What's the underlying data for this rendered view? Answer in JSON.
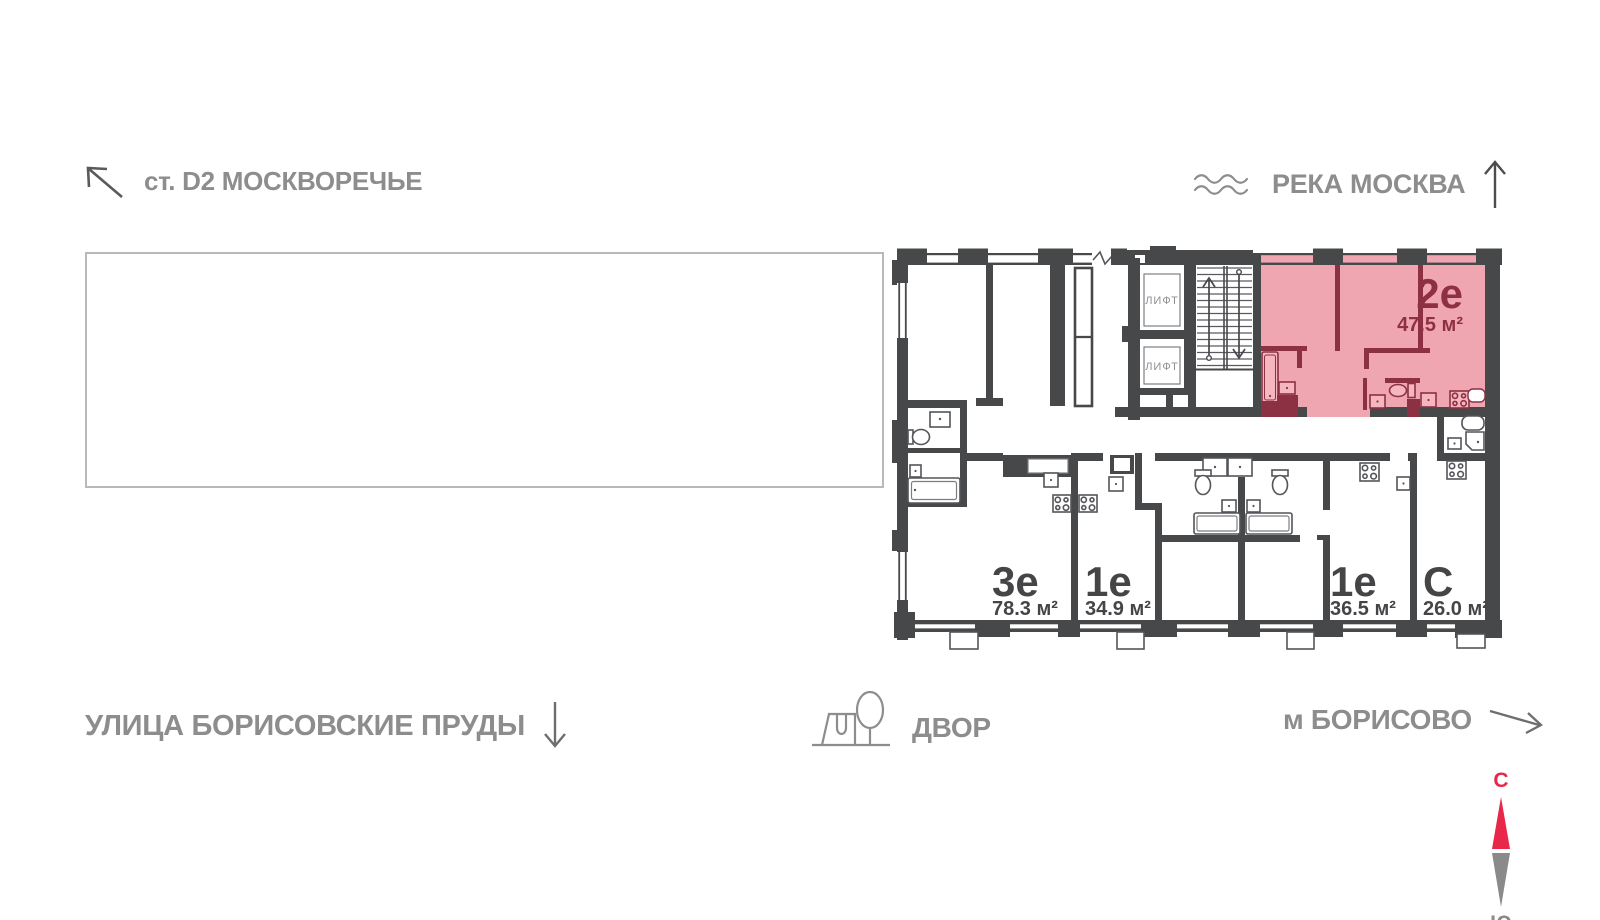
{
  "legend": {
    "station": "ст. D2 МОСКВОРЕЧЬЕ",
    "river": "РЕКА МОСКВА",
    "street": "УЛИЦА БОРИСОВСКИЕ ПРУДЫ",
    "yard": "ДВОР",
    "metro": "м БОРИСОВО"
  },
  "compass": {
    "north": "С",
    "south": "Ю"
  },
  "plan": {
    "lift_label": "ЛИФТ",
    "apartments": [
      {
        "type": "2е",
        "area": "47.5 м²",
        "highlighted": true
      },
      {
        "type": "3е",
        "area": "78.3 м²",
        "highlighted": false
      },
      {
        "type": "1е",
        "area": "34.9 м²",
        "highlighted": false
      },
      {
        "type": "1е",
        "area": "36.5 м²",
        "highlighted": false
      },
      {
        "type": "С",
        "area": "26.0 м²",
        "highlighted": false
      }
    ]
  },
  "colors": {
    "wall": "#47484a",
    "highlight_fill": "#f0a6b1",
    "highlight_wall": "#8c3143",
    "highlight_text": "#8e3043",
    "apartment_text": "#454547",
    "legend_text": "#8d8d8d",
    "compass_north": "#e8274b",
    "compass_south": "#8a8a8a"
  }
}
